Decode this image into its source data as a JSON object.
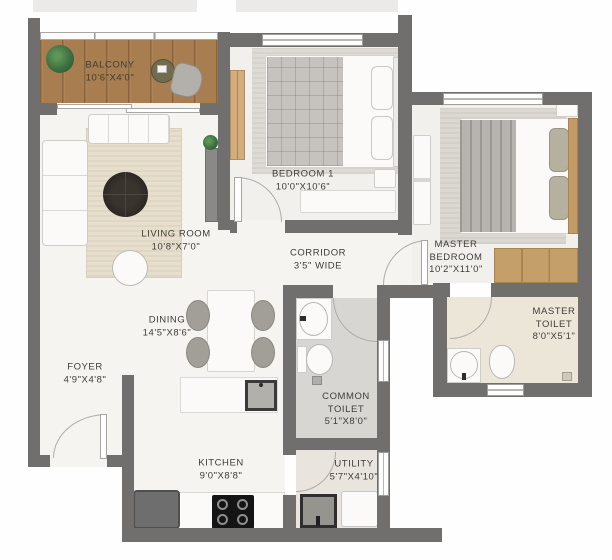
{
  "plan": {
    "type": "apartment-floor-plan",
    "rooms": [
      {
        "id": "balcony",
        "name": "BALCONY",
        "dims": "10'6\"X4'0\""
      },
      {
        "id": "bedroom-1",
        "name": "BEDROOM 1",
        "dims": "10'0\"X10'6\""
      },
      {
        "id": "master-bedroom",
        "name": "MASTER BEDROOM",
        "dims": "10'2\"X11'0\""
      },
      {
        "id": "living-room",
        "name": "LIVING ROOM",
        "dims": "10'8\"X7'0\""
      },
      {
        "id": "corridor",
        "name": "CORRIDOR",
        "dims": "3'5\" WIDE"
      },
      {
        "id": "dining",
        "name": "DINING",
        "dims": "14'5\"X8'6\""
      },
      {
        "id": "foyer",
        "name": "FOYER",
        "dims": "4'9\"X4'8\""
      },
      {
        "id": "common-toilet",
        "name": "COMMON TOILET",
        "dims": "5'1\"X8'0\""
      },
      {
        "id": "master-toilet",
        "name": "MASTER TOILET",
        "dims": "8'0\"X5'1\""
      },
      {
        "id": "kitchen",
        "name": "KITCHEN",
        "dims": "9'0\"X8'8\""
      },
      {
        "id": "utility",
        "name": "UTILITY",
        "dims": "5'7\"X4'10\""
      }
    ],
    "colors": {
      "wall": "#716f6d",
      "balcony_wood": "#a87d50",
      "living_rug": "#e7dfcc",
      "wood_accent": "#c49f6b",
      "common_toilet_floor": "#d8d6d3",
      "master_toilet_floor": "#ece6d8",
      "label_text": "#3e3d3b"
    }
  }
}
